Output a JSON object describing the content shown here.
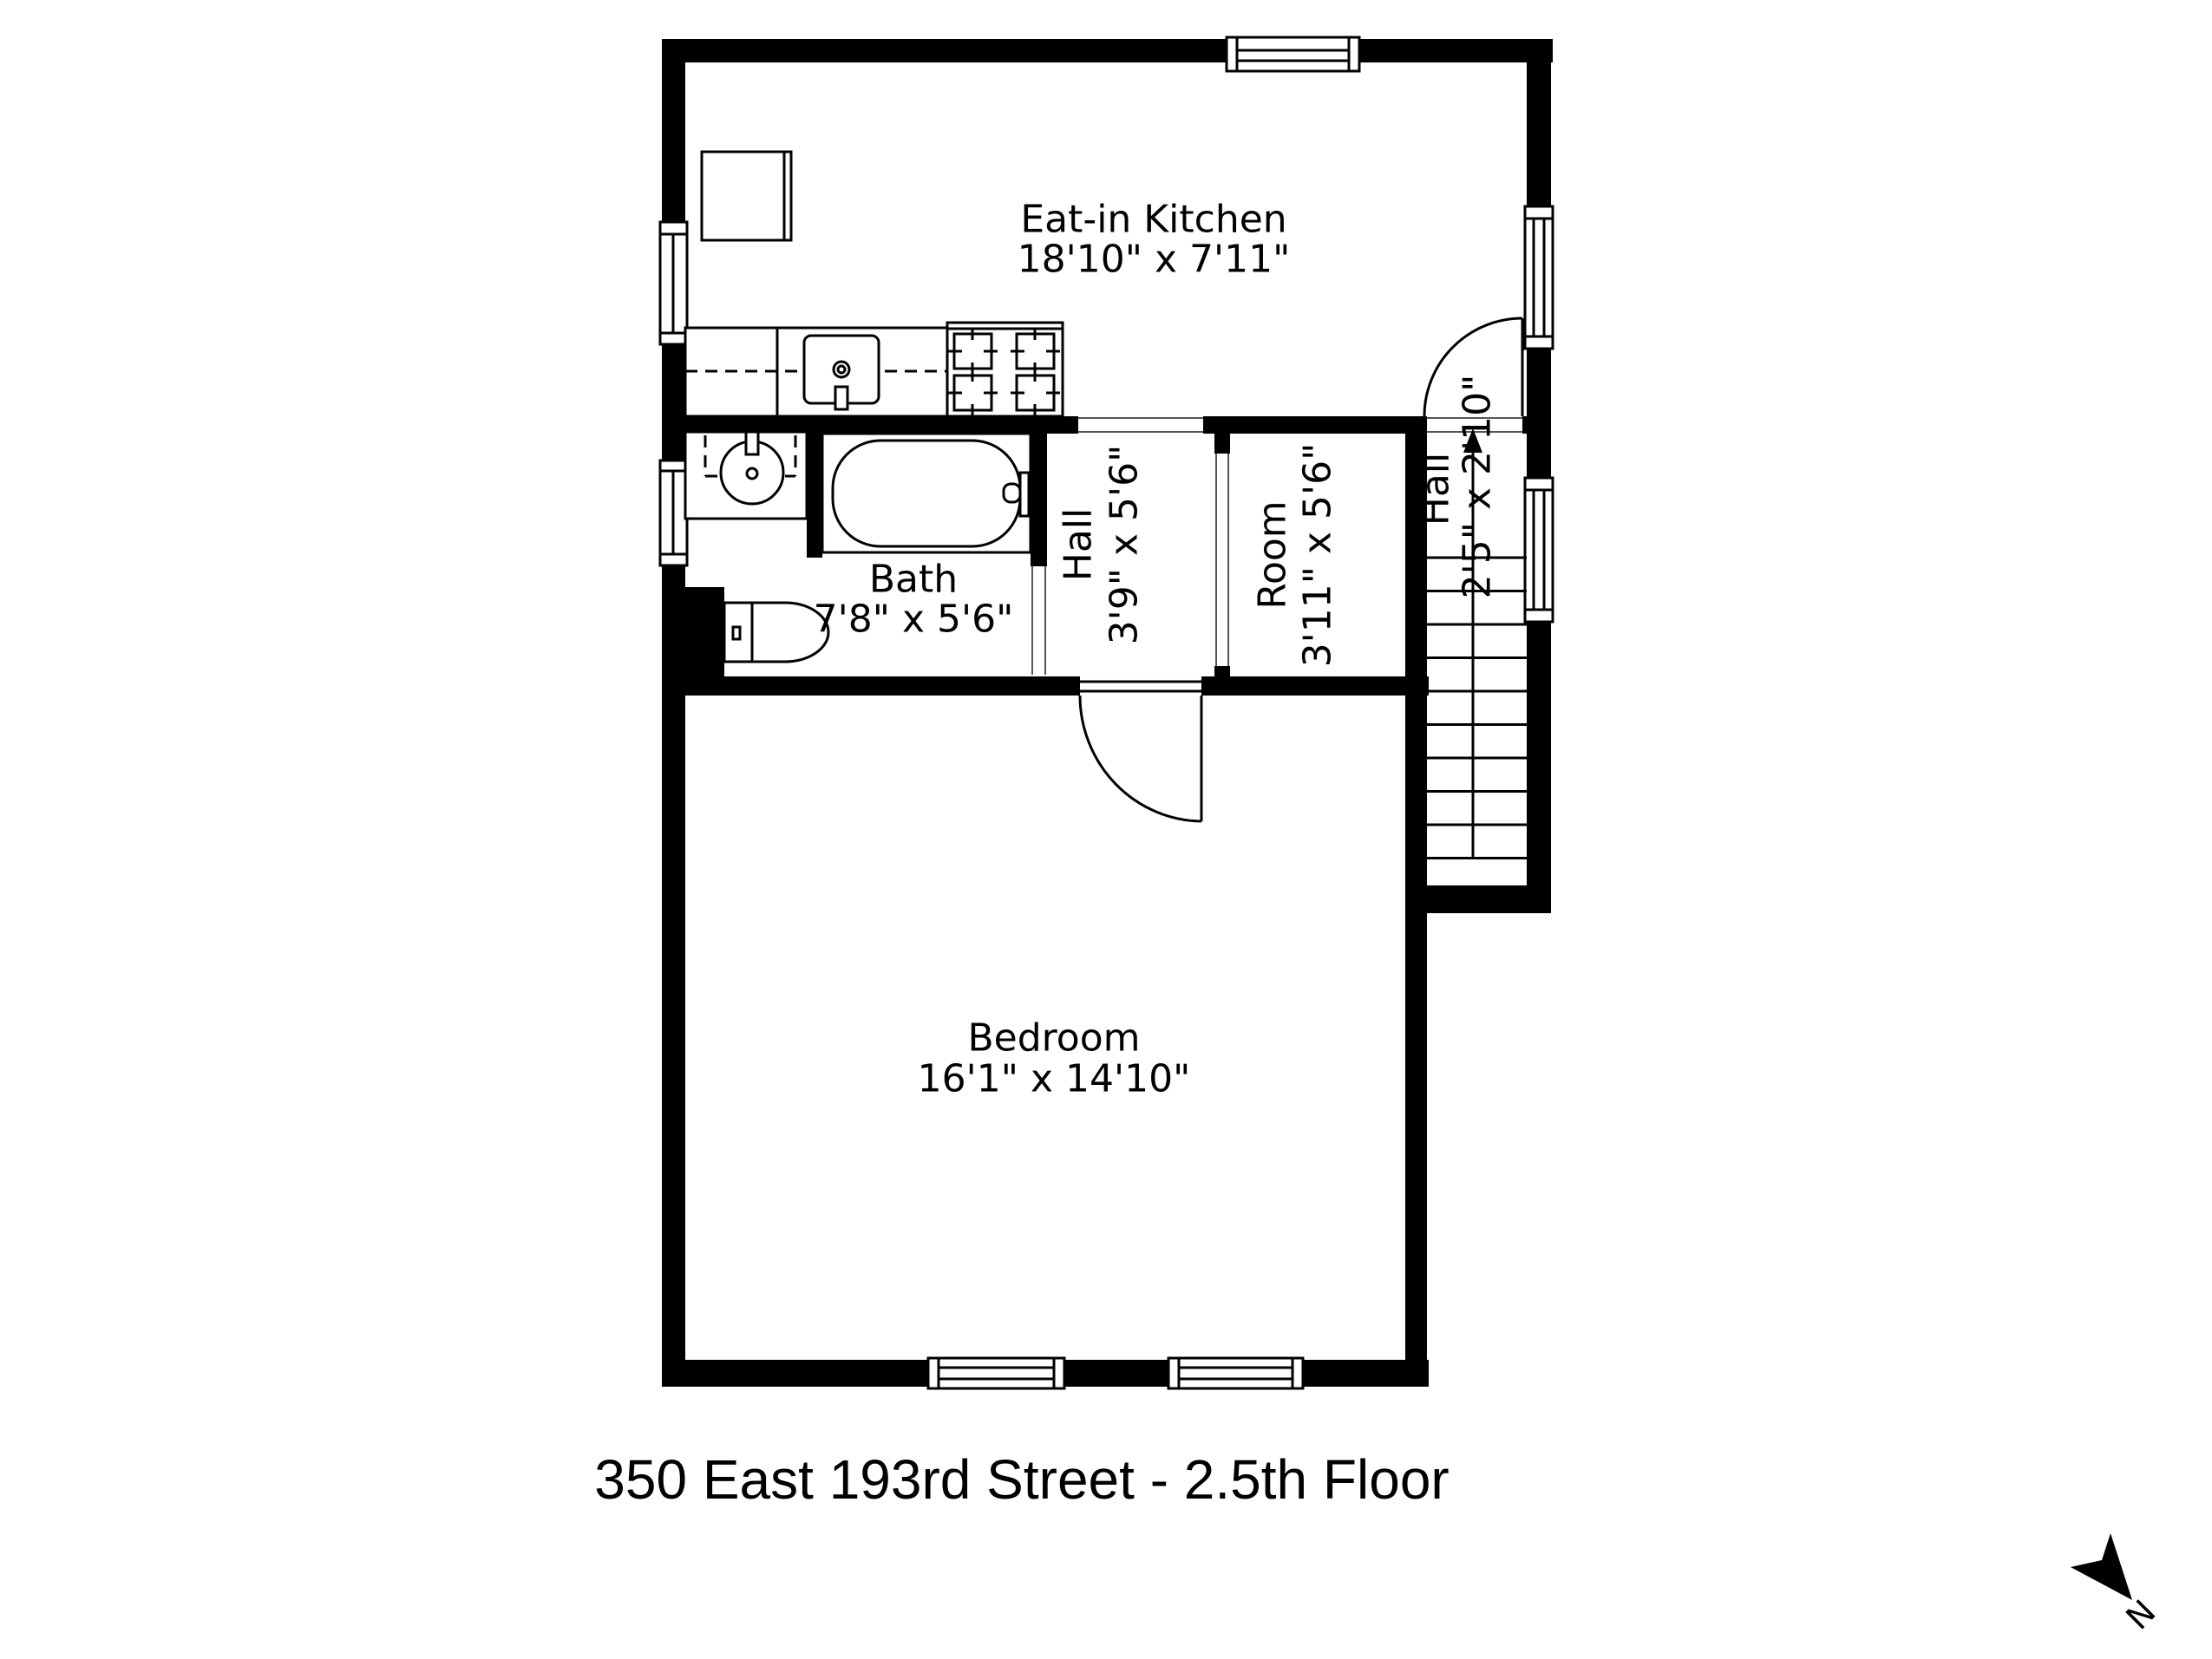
{
  "page": {
    "background": "#ffffff",
    "ink": "#000000"
  },
  "title": {
    "text": "350 East 193rd Street - 2.5th Floor"
  },
  "compass": {
    "label": "N"
  },
  "rooms": {
    "kitchen": {
      "name": "Eat-in Kitchen",
      "dims": "18'10\" x 7'11\""
    },
    "bath": {
      "name": "Bath",
      "dims": "7'8\" x 5'6\""
    },
    "hall": {
      "name": "Hall",
      "dims": "3'9\" x 5'6\""
    },
    "room": {
      "name": "Room",
      "dims": "3'11\" x 5'6\""
    },
    "entry_hall": {
      "name": "Hall",
      "dims": "2'5\" x 2'10\""
    },
    "bedroom": {
      "name": "Bedroom",
      "dims": "16'1\" x 14'10\""
    }
  },
  "fixtures": {
    "refrigerator": "refrigerator",
    "kitchen_counter": "kitchen-counter",
    "kitchen_sink": "kitchen-sink",
    "stove": "gas-stove",
    "bathroom_sink": "bathroom-sink",
    "bathtub": "bathtub",
    "toilet": "toilet",
    "stairs": "staircase"
  }
}
